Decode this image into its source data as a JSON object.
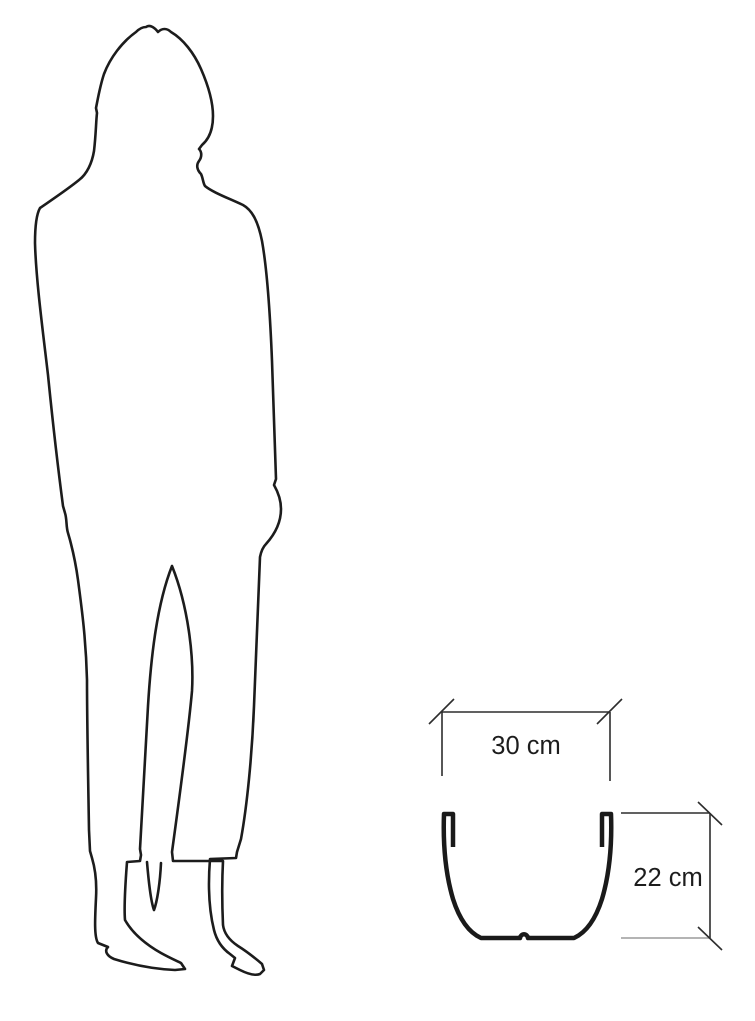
{
  "diagram": {
    "kind": "size-comparison",
    "dimensions": {
      "width": {
        "label": "30 cm"
      },
      "height": {
        "label": "22 cm"
      }
    }
  },
  "colors": {
    "outline": "#1c1c1c",
    "pot_outline": "#1a1a1a",
    "dimension_line": "#2d2d2d",
    "dimension_line_light": "#9c9c9c",
    "label_text": "#1d1d1d",
    "background": "#ffffff"
  }
}
